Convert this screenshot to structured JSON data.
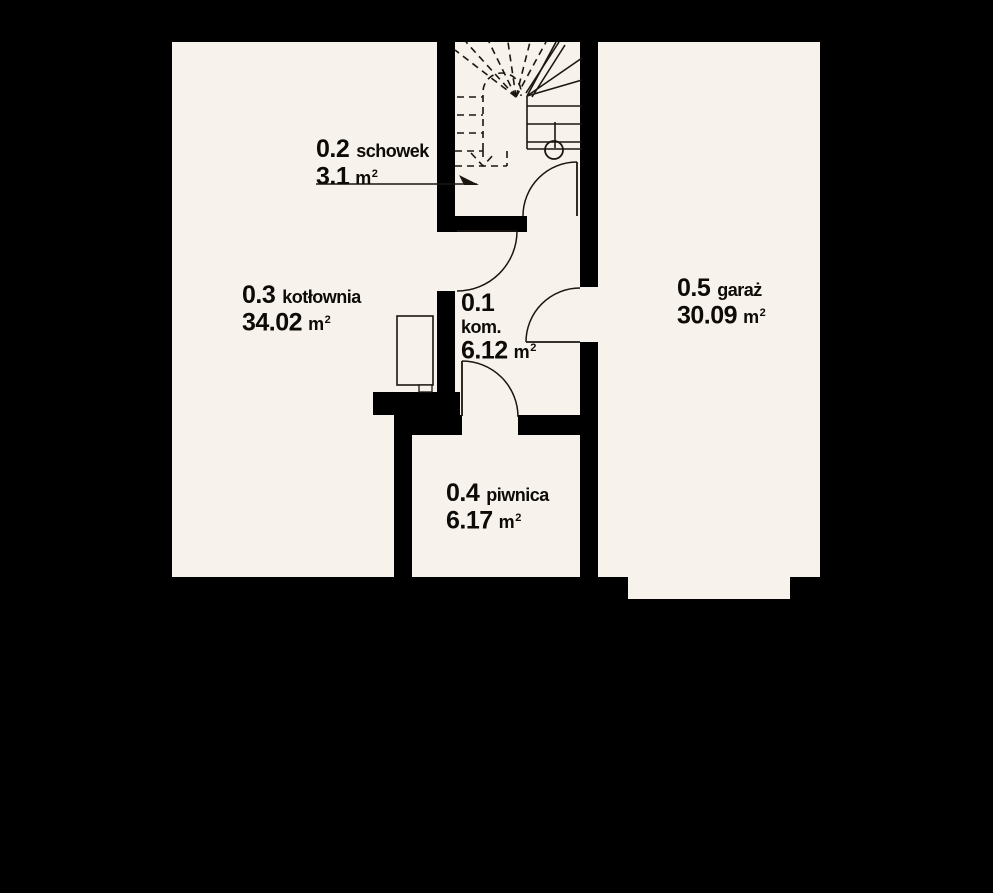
{
  "plan": {
    "type": "floor-plan",
    "level": "basement",
    "colors": {
      "background": "#000000",
      "floor": "#f7f2ec",
      "wall": "#000000",
      "line": "#1b1611",
      "text": "#0d0b08"
    },
    "rooms": {
      "kom": {
        "number": "0.1",
        "name": "kom.",
        "area": "6.12",
        "unit": "m",
        "sup": "2"
      },
      "schowek": {
        "number": "0.2",
        "name": "schowek",
        "area": "3.1",
        "unit": "m",
        "sup": "2"
      },
      "kotlownia": {
        "number": "0.3",
        "name": "kotłownia",
        "area": "34.02",
        "unit": "m",
        "sup": "2"
      },
      "piwnica": {
        "number": "0.4",
        "name": "piwnica",
        "area": "6.17",
        "unit": "m",
        "sup": "2"
      },
      "garaz": {
        "number": "0.5",
        "name": "garaż",
        "area": "30.09",
        "unit": "m",
        "sup": "2"
      }
    }
  }
}
